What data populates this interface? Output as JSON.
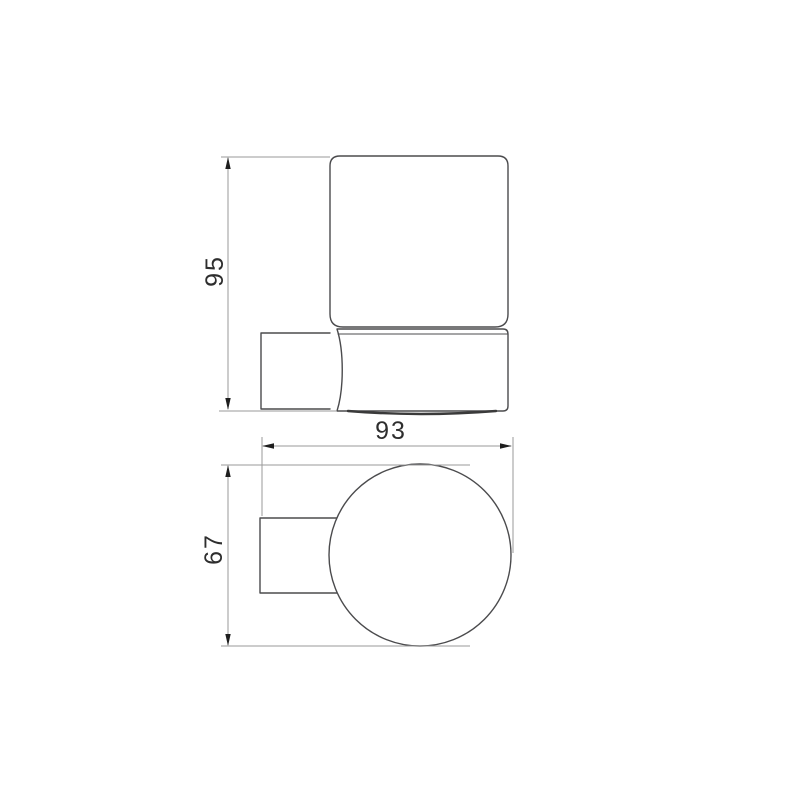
{
  "drawing": {
    "dimensions": {
      "height": "95",
      "width": "93",
      "depth": "67"
    },
    "colors": {
      "outline": "#4b4b4d",
      "base_edge": "#3a3a3a",
      "dimension_line": "#9a9a9a",
      "arrow": "#1e1e1e",
      "text": "#2e2e2e",
      "background": "#ffffff"
    }
  }
}
